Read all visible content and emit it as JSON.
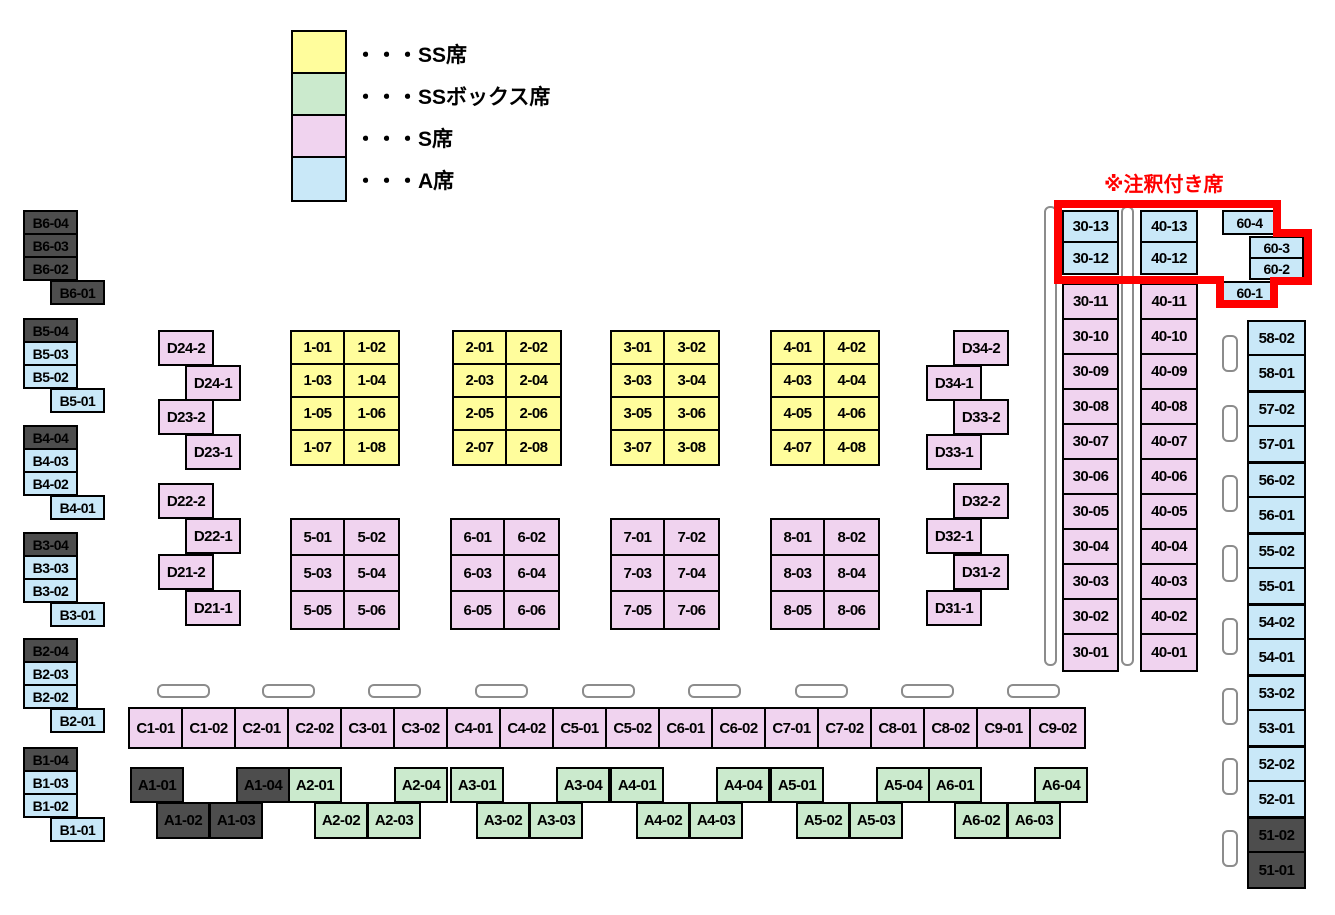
{
  "legend": {
    "items": [
      {
        "type": "ss",
        "label": "・・・SS席"
      },
      {
        "type": "ss_box",
        "label": "・・・SSボックス席"
      },
      {
        "type": "s",
        "label": "・・・S席"
      },
      {
        "type": "a",
        "label": "・・・A席"
      }
    ]
  },
  "annotation": {
    "label": "※注釈付き席",
    "color": "#FF0000",
    "seats": [
      "30-13",
      "30-12",
      "40-13",
      "40-12",
      "60-4",
      "60-3",
      "60-2",
      "60-1"
    ]
  },
  "colors": {
    "ss": "#FFFD9C",
    "ss_box": "#CBEACD",
    "s": "#F0D3EF",
    "a": "#C9E8F8",
    "sold": "#4D4D4D",
    "seat_border": "#000000",
    "marker_border": "#8C8C8C",
    "background": "#FFFFFF",
    "text": "#000000"
  },
  "seats": {
    "singles": [
      [
        "B6-04",
        23,
        210,
        55,
        25,
        "sold"
      ],
      [
        "B6-03",
        23,
        233,
        55,
        25,
        "sold"
      ],
      [
        "B6-02",
        23,
        256,
        55,
        25,
        "sold"
      ],
      [
        "B6-01",
        50,
        280,
        55,
        25,
        "sold"
      ],
      [
        "B5-04",
        23,
        318,
        55,
        25,
        "sold"
      ],
      [
        "B5-03",
        23,
        341,
        55,
        25,
        "a"
      ],
      [
        "B5-02",
        23,
        364,
        55,
        25,
        "a"
      ],
      [
        "B5-01",
        50,
        388,
        55,
        25,
        "a"
      ],
      [
        "B4-04",
        23,
        425,
        55,
        25,
        "sold"
      ],
      [
        "B4-03",
        23,
        448,
        55,
        25,
        "a"
      ],
      [
        "B4-02",
        23,
        471,
        55,
        25,
        "a"
      ],
      [
        "B4-01",
        50,
        495,
        55,
        25,
        "a"
      ],
      [
        "B3-04",
        23,
        532,
        55,
        25,
        "sold"
      ],
      [
        "B3-03",
        23,
        555,
        55,
        25,
        "a"
      ],
      [
        "B3-02",
        23,
        578,
        55,
        25,
        "a"
      ],
      [
        "B3-01",
        50,
        602,
        55,
        25,
        "a"
      ],
      [
        "B2-04",
        23,
        638,
        55,
        25,
        "sold"
      ],
      [
        "B2-03",
        23,
        661,
        55,
        25,
        "a"
      ],
      [
        "B2-02",
        23,
        684,
        55,
        25,
        "a"
      ],
      [
        "B2-01",
        50,
        708,
        55,
        25,
        "a"
      ],
      [
        "B1-04",
        23,
        747,
        55,
        25,
        "sold"
      ],
      [
        "B1-03",
        23,
        770,
        55,
        25,
        "a"
      ],
      [
        "B1-02",
        23,
        793,
        55,
        25,
        "a"
      ],
      [
        "B1-01",
        50,
        817,
        55,
        25,
        "a"
      ],
      [
        "D24-2",
        158,
        330,
        56,
        36,
        "s"
      ],
      [
        "D24-1",
        185,
        365,
        56,
        36,
        "s"
      ],
      [
        "D23-2",
        158,
        399,
        56,
        36,
        "s"
      ],
      [
        "D23-1",
        185,
        434,
        56,
        36,
        "s"
      ],
      [
        "D22-2",
        158,
        483,
        56,
        36,
        "s"
      ],
      [
        "D22-1",
        185,
        518,
        56,
        36,
        "s"
      ],
      [
        "D21-2",
        158,
        554,
        56,
        36,
        "s"
      ],
      [
        "D21-1",
        185,
        590,
        56,
        36,
        "s"
      ],
      [
        "D34-2",
        953,
        330,
        56,
        36,
        "s"
      ],
      [
        "D34-1",
        926,
        365,
        56,
        36,
        "s"
      ],
      [
        "D33-2",
        953,
        399,
        56,
        36,
        "s"
      ],
      [
        "D33-1",
        926,
        434,
        56,
        36,
        "s"
      ],
      [
        "D32-2",
        953,
        483,
        56,
        36,
        "s"
      ],
      [
        "D32-1",
        926,
        518,
        56,
        36,
        "s"
      ],
      [
        "D31-2",
        953,
        554,
        56,
        36,
        "s"
      ],
      [
        "D31-1",
        926,
        590,
        56,
        36,
        "s"
      ],
      [
        "30-13",
        1062,
        210,
        57,
        33,
        "a"
      ],
      [
        "30-12",
        1062,
        241,
        57,
        34,
        "a"
      ],
      [
        "40-13",
        1140,
        210,
        58,
        33,
        "a"
      ],
      [
        "40-12",
        1140,
        241,
        58,
        34,
        "a"
      ],
      [
        "60-4",
        1222,
        210,
        55,
        25,
        "a"
      ],
      [
        "60-3",
        1249,
        236,
        55,
        23,
        "a"
      ],
      [
        "60-2",
        1249,
        257,
        55,
        23,
        "a"
      ],
      [
        "60-1",
        1222,
        281,
        55,
        23,
        "a"
      ],
      [
        "A1-01",
        130,
        767,
        54,
        36,
        "sold"
      ],
      [
        "A1-04",
        236,
        767,
        54,
        36,
        "sold"
      ],
      [
        "A1-02",
        156,
        802,
        54,
        37,
        "sold"
      ],
      [
        "A1-03",
        209,
        802,
        54,
        37,
        "sold"
      ],
      [
        "A2-01",
        288,
        767,
        54,
        36,
        "ss_box"
      ],
      [
        "A2-04",
        394,
        767,
        54,
        36,
        "ss_box"
      ],
      [
        "A2-02",
        314,
        802,
        54,
        37,
        "ss_box"
      ],
      [
        "A2-03",
        367,
        802,
        54,
        37,
        "ss_box"
      ],
      [
        "A3-01",
        450,
        767,
        54,
        36,
        "ss_box"
      ],
      [
        "A3-04",
        556,
        767,
        54,
        36,
        "ss_box"
      ],
      [
        "A3-02",
        476,
        802,
        54,
        37,
        "ss_box"
      ],
      [
        "A3-03",
        529,
        802,
        54,
        37,
        "ss_box"
      ],
      [
        "A4-01",
        610,
        767,
        54,
        36,
        "ss_box"
      ],
      [
        "A4-04",
        716,
        767,
        54,
        36,
        "ss_box"
      ],
      [
        "A4-02",
        636,
        802,
        54,
        37,
        "ss_box"
      ],
      [
        "A4-03",
        689,
        802,
        54,
        37,
        "ss_box"
      ],
      [
        "A5-01",
        770,
        767,
        54,
        36,
        "ss_box"
      ],
      [
        "A5-04",
        876,
        767,
        54,
        36,
        "ss_box"
      ],
      [
        "A5-02",
        796,
        802,
        54,
        37,
        "ss_box"
      ],
      [
        "A5-03",
        849,
        802,
        54,
        37,
        "ss_box"
      ],
      [
        "A6-01",
        928,
        767,
        54,
        36,
        "ss_box"
      ],
      [
        "A6-04",
        1034,
        767,
        54,
        36,
        "ss_box"
      ],
      [
        "A6-02",
        954,
        802,
        54,
        37,
        "ss_box"
      ],
      [
        "A6-03",
        1007,
        802,
        54,
        37,
        "ss_box"
      ]
    ],
    "blocks": [
      {
        "x": 290,
        "y": 330,
        "cw": 53,
        "ch": 33,
        "type": "ss",
        "labels": [
          [
            "1-01",
            "1-02"
          ],
          [
            "1-03",
            "1-04"
          ],
          [
            "1-05",
            "1-06"
          ],
          [
            "1-07",
            "1-08"
          ]
        ]
      },
      {
        "x": 452,
        "y": 330,
        "cw": 53,
        "ch": 33,
        "type": "ss",
        "labels": [
          [
            "2-01",
            "2-02"
          ],
          [
            "2-03",
            "2-04"
          ],
          [
            "2-05",
            "2-06"
          ],
          [
            "2-07",
            "2-08"
          ]
        ]
      },
      {
        "x": 610,
        "y": 330,
        "cw": 53,
        "ch": 33,
        "type": "ss",
        "labels": [
          [
            "3-01",
            "3-02"
          ],
          [
            "3-03",
            "3-04"
          ],
          [
            "3-05",
            "3-06"
          ],
          [
            "3-07",
            "3-08"
          ]
        ]
      },
      {
        "x": 770,
        "y": 330,
        "cw": 53,
        "ch": 33,
        "type": "ss",
        "labels": [
          [
            "4-01",
            "4-02"
          ],
          [
            "4-03",
            "4-04"
          ],
          [
            "4-05",
            "4-06"
          ],
          [
            "4-07",
            "4-08"
          ]
        ]
      },
      {
        "x": 290,
        "y": 518,
        "cw": 53,
        "ch": 36,
        "type": "s",
        "labels": [
          [
            "5-01",
            "5-02"
          ],
          [
            "5-03",
            "5-04"
          ],
          [
            "5-05",
            "5-06"
          ]
        ]
      },
      {
        "x": 450,
        "y": 518,
        "cw": 53,
        "ch": 36,
        "type": "s",
        "labels": [
          [
            "6-01",
            "6-02"
          ],
          [
            "6-03",
            "6-04"
          ],
          [
            "6-05",
            "6-06"
          ]
        ]
      },
      {
        "x": 610,
        "y": 518,
        "cw": 53,
        "ch": 36,
        "type": "s",
        "labels": [
          [
            "7-01",
            "7-02"
          ],
          [
            "7-03",
            "7-04"
          ],
          [
            "7-05",
            "7-06"
          ]
        ]
      },
      {
        "x": 770,
        "y": 518,
        "cw": 53,
        "ch": 36,
        "type": "s",
        "labels": [
          [
            "8-01",
            "8-02"
          ],
          [
            "8-03",
            "8-04"
          ],
          [
            "8-05",
            "8-06"
          ]
        ]
      },
      {
        "x": 128,
        "y": 707,
        "cw": 53,
        "ch": 38,
        "type": "s",
        "labels": [
          [
            "C1-01",
            "C1-02",
            "C2-01",
            "C2-02",
            "C3-01",
            "C3-02",
            "C4-01",
            "C4-02",
            "C5-01",
            "C5-02",
            "C6-01",
            "C6-02",
            "C7-01",
            "C7-02",
            "C8-01",
            "C8-02",
            "C9-01",
            "C9-02"
          ]
        ]
      },
      {
        "x": 1062,
        "y": 283,
        "cw": 53,
        "ch": 35,
        "type": "s",
        "labels": [
          [
            "30-11"
          ],
          [
            "30-10"
          ],
          [
            "30-09"
          ],
          [
            "30-08"
          ],
          [
            "30-07"
          ],
          [
            "30-06"
          ],
          [
            "30-05"
          ],
          [
            "30-04"
          ],
          [
            "30-03"
          ],
          [
            "30-02"
          ],
          [
            "30-01"
          ]
        ]
      },
      {
        "x": 1140,
        "y": 283,
        "cw": 54,
        "ch": 35,
        "type": "s",
        "labels": [
          [
            "40-11"
          ],
          [
            "40-10"
          ],
          [
            "40-09"
          ],
          [
            "40-08"
          ],
          [
            "40-07"
          ],
          [
            "40-06"
          ],
          [
            "40-05"
          ],
          [
            "40-04"
          ],
          [
            "40-03"
          ],
          [
            "40-02"
          ],
          [
            "40-01"
          ]
        ]
      },
      {
        "x": 1247,
        "y": 320,
        "cw": 55,
        "ch": 34,
        "type": "a",
        "labels": [
          [
            "58-02"
          ],
          [
            "58-01"
          ]
        ]
      },
      {
        "x": 1247,
        "y": 391,
        "cw": 55,
        "ch": 34,
        "type": "a",
        "labels": [
          [
            "57-02"
          ],
          [
            "57-01"
          ]
        ]
      },
      {
        "x": 1247,
        "y": 462,
        "cw": 55,
        "ch": 34,
        "type": "a",
        "labels": [
          [
            "56-02"
          ],
          [
            "56-01"
          ]
        ]
      },
      {
        "x": 1247,
        "y": 533,
        "cw": 55,
        "ch": 34,
        "type": "a",
        "labels": [
          [
            "55-02"
          ],
          [
            "55-01"
          ]
        ]
      },
      {
        "x": 1247,
        "y": 604,
        "cw": 55,
        "ch": 34,
        "type": "a",
        "labels": [
          [
            "54-02"
          ],
          [
            "54-01"
          ]
        ]
      },
      {
        "x": 1247,
        "y": 675,
        "cw": 55,
        "ch": 34,
        "type": "a",
        "labels": [
          [
            "53-02"
          ],
          [
            "53-01"
          ]
        ]
      },
      {
        "x": 1247,
        "y": 746,
        "cw": 55,
        "ch": 34,
        "type": "a",
        "labels": [
          [
            "52-02"
          ],
          [
            "52-01"
          ]
        ]
      },
      {
        "x": 1247,
        "y": 817,
        "cw": 55,
        "ch": 34,
        "type": "sold",
        "labels": [
          [
            "51-02"
          ],
          [
            "51-01"
          ]
        ]
      }
    ]
  },
  "markers": {
    "horizontal": {
      "y": 684,
      "w": 53,
      "h": 14,
      "xs": [
        157,
        262,
        368,
        475,
        582,
        688,
        795,
        901,
        1007
      ]
    },
    "tall": {
      "y": 206,
      "w": 13,
      "h": 460,
      "xs": [
        1044,
        1121
      ]
    },
    "small": {
      "x": 1222,
      "w": 16,
      "h": 37,
      "ys": [
        335,
        405,
        475,
        545,
        618,
        688,
        758,
        830
      ]
    }
  }
}
